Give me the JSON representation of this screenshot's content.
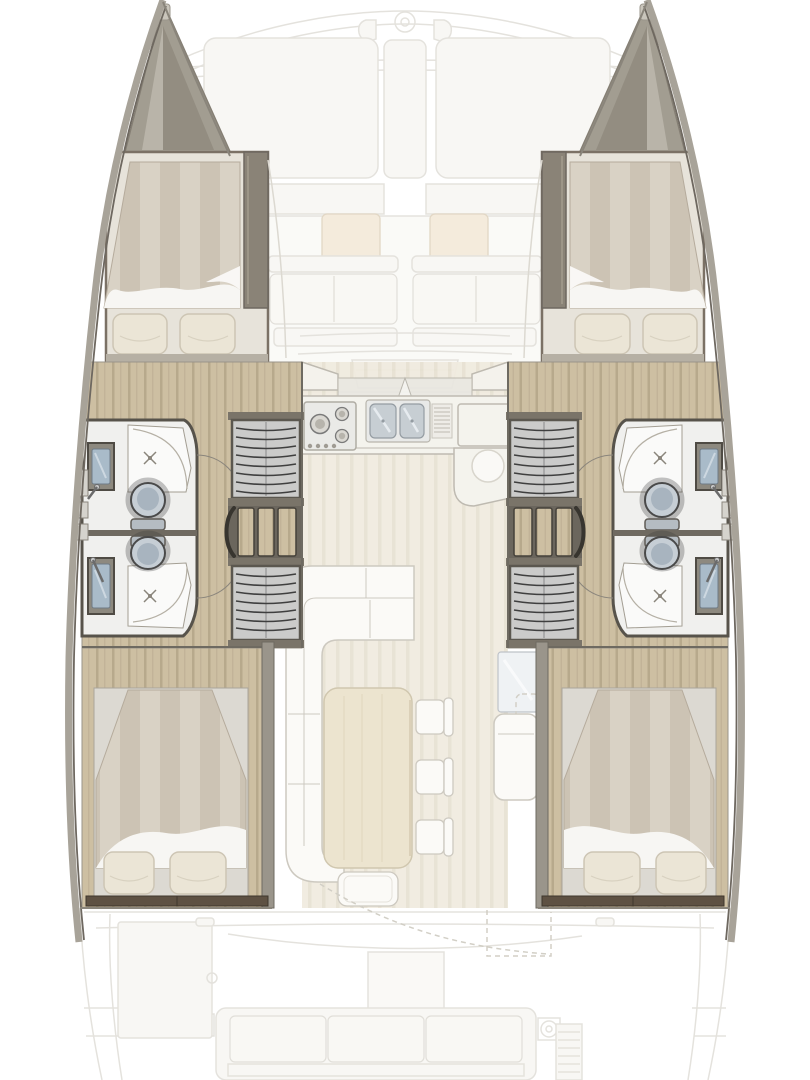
{
  "vessel": {
    "type": "catamaran-interior-floor-plan",
    "orientation": "top-down, bow at top, stern at bottom",
    "exterior_ghosted": {
      "bow": [
        "forestay-ring",
        "bow-pulpit-rails",
        "cross-beam",
        "two-cleats"
      ],
      "foredeck": [
        "port-sunpad",
        "center-hatch-strip",
        "starboard-sunpad"
      ],
      "forward_cockpit": [
        "two-wood-tables",
        "two-facing-benches",
        "center-steps"
      ],
      "aft_cockpit": [
        "cockpit-table",
        "three-cushion-bench",
        "port-winch",
        "starboard-winch",
        "storage-hatch",
        "slatted-locker",
        "sliding-door-dashed-swing"
      ]
    },
    "salon": {
      "galley": [
        "three-burner-stove",
        "double-stainless-sink",
        "faucet",
        "dish-drainer",
        "fridge-counter",
        "rounded-peninsula"
      ],
      "dinette": [
        "l-shaped-sofa",
        "rect-dining-table",
        "chair-1",
        "chair-2",
        "chair-3",
        "bench-stool"
      ],
      "nav": [
        "nav-panel",
        "nav-seat"
      ]
    },
    "port_hull": {
      "forward_cabin": [
        "island-bed",
        "two-pillows",
        "wardrobe-panel"
      ],
      "heads": [
        "fwd-shower",
        "fwd-vanity-sink",
        "fwd-toilet",
        "aft-toilet",
        "aft-vanity-sink",
        "aft-shower",
        "wall-lockers"
      ],
      "passage": [
        "wardrobe-fwd",
        "companionway-steps",
        "wardrobe-aft",
        "door-swing-arcs"
      ],
      "aft_cabin": [
        "island-bed",
        "two-pillows",
        "foot-shelf"
      ]
    },
    "starboard_hull": "mirror-of-port-hull",
    "counts": {
      "cabins": 4,
      "double_berths": 4,
      "heads": 4,
      "toilets": 4,
      "showers": 4,
      "vanity_sinks": 4,
      "wardrobes": 4
    }
  },
  "colors": {
    "background": "#ffffff",
    "ghost_fill": "#f4f2ec",
    "ghost_line": "#cfccc2",
    "salon_floor": "#f0ebdf",
    "salon_floor_stripe": "#e7e1d2",
    "wood_floor": "#cdbfa2",
    "wood_floor_stripe": "#b7a98c",
    "hull_wall": "#a8a399",
    "hull_wall_dark": "#6e6860",
    "bulkhead": "#57534b",
    "cabin_panel": "#8a8377",
    "mattress": "#d9d2c5",
    "mattress_stripe": "#ccc3b4",
    "sheet": "#f7f6f3",
    "pillow": "#ebe5d6",
    "pillow_edge": "#cdc5b4",
    "bath_floor": "#f0f0ee",
    "shower_floor": "#fafaf9",
    "toilet_body": "#c6ced5",
    "toilet_inner": "#a8b4bf",
    "sink_basin": "#a9bbc9",
    "sink_counter": "#8d897f",
    "wardrobe_fill": "#cbcbca",
    "wardrobe_slat": "#3f3f3f",
    "stairs_bg": "#6b665d",
    "counter": "#f4f2ec",
    "counter_line": "#b9b5ab",
    "steel": "#c3cad0",
    "table_wood": "#ebe2cb",
    "sofa": "#fbfaf7",
    "sofa_line": "#c9c5bb",
    "foot_shelf": "#5e5143",
    "tan_table": "#ecdcc0"
  }
}
